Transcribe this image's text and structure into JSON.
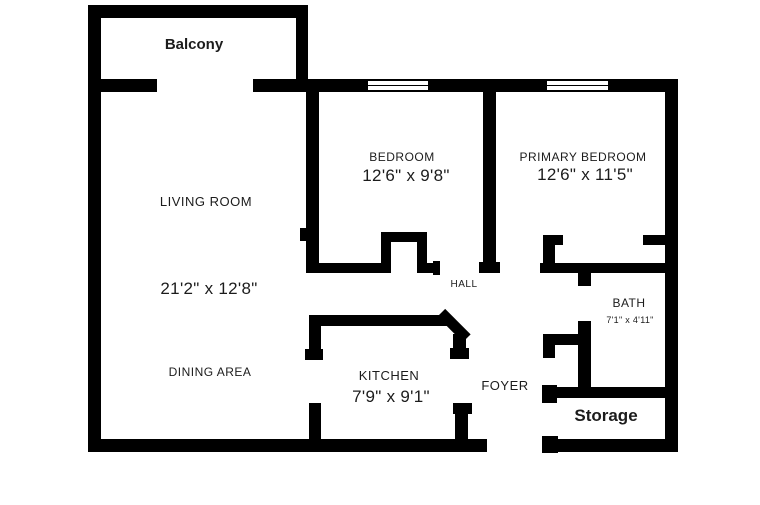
{
  "title": "Apartment floor plan",
  "colors": {
    "wall": "#000000",
    "background": "#ffffff",
    "text": "#1c1c1c"
  },
  "rooms": {
    "balcony": {
      "label": "Balcony"
    },
    "living": {
      "label": "LIVING ROOM",
      "dims": "21'2\" x 12'8\""
    },
    "bedroom": {
      "label": "BEDROOM",
      "dims": "12'6\" x 9'8\""
    },
    "primary": {
      "label": "PRIMARY BEDROOM",
      "dims": "12'6\" x 11'5\""
    },
    "hall": {
      "label": "HALL"
    },
    "kitchen": {
      "label": "KITCHEN",
      "dims": "7'9\" x 9'1\""
    },
    "dining": {
      "label": "DINING AREA"
    },
    "foyer": {
      "label": "FOYER"
    },
    "bath": {
      "label": "BATH",
      "dims": "7'1\" x 4'11\""
    },
    "storage": {
      "label": "Storage"
    }
  }
}
